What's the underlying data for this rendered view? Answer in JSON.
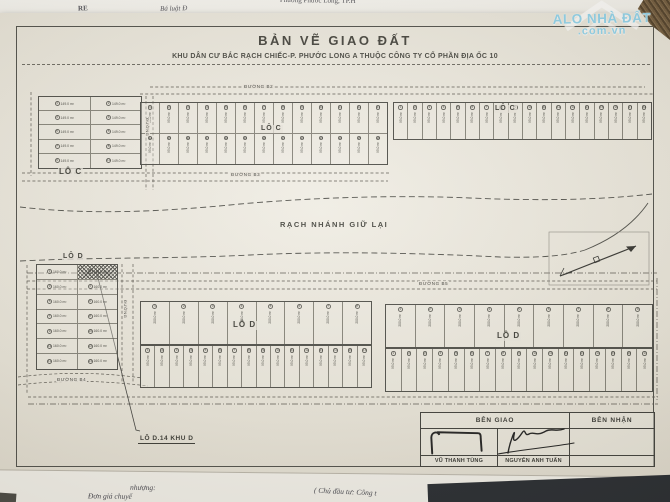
{
  "photo": {
    "watermark": {
      "line1": "ALO NHÀ ĐẤT",
      "line2": ".com.vn",
      "color": "#8ed2ea"
    },
    "underlying_papers": {
      "top_left": "RE",
      "top_mid": "Bá luật Đ",
      "top_right_1": "Phường Phước Long, TP.H",
      "top_right_2": "Phường Phước Long A",
      "bottom_mid": "nhượng:",
      "bottom_left": "Đơn giá chuyể",
      "bottom_right": "( Chủ đầu tư: Công t"
    }
  },
  "drawing": {
    "title": "BẢN VẼ GIAO ĐẤT",
    "subtitle": "KHU DÂN CƯ BẮC RẠCH CHIẾC-P. PHƯỚC LONG A THUỘC CÔNG TY CỔ PHẦN ĐỊA ỐC 10",
    "canal_label": "RẠCH NHÁNH GIỮ LẠI",
    "callout_label": "LÔ D.14 KHU D",
    "labels": {
      "lo_c": "LÔ C",
      "lo_d": "LÔ D"
    },
    "streets": {
      "top": "ĐƯỜNG B2",
      "below_upper_mid": "ĐƯỜNG B3",
      "middle": "ĐƯỜNG B5",
      "bottom_left": "ĐƯỜNG B4",
      "vertical_left": "ĐƯỜNG",
      "vertical_upper": "ĐƯỜNG"
    },
    "colors": {
      "paper": "#eae6dc",
      "ink": "#3b3b35"
    },
    "blocks": [
      {
        "name": "block-lo-c-west",
        "x": 38,
        "y": 96,
        "w": 104,
        "h": 73,
        "rows": 5,
        "cols": 2,
        "type": "wide",
        "cell_area": "149.0 m²"
      },
      {
        "name": "block-lo-c-mid",
        "x": 140,
        "y": 102,
        "w": 248,
        "h": 63,
        "rows": 2,
        "cols": 13,
        "type": "strip",
        "cell_area": "95.0 m²"
      },
      {
        "name": "block-lo-c-east",
        "x": 393,
        "y": 102,
        "w": 259,
        "h": 38,
        "rows": 1,
        "cols": 18,
        "type": "strip",
        "cell_area": "95.0 m²"
      },
      {
        "name": "block-lo-d-west",
        "x": 36,
        "y": 264,
        "w": 82,
        "h": 106,
        "rows": 7,
        "cols": 2,
        "type": "wide",
        "cell_area": "160.0 m²",
        "hatch": [
          0,
          1
        ]
      },
      {
        "name": "block-lo-d-mid-top",
        "x": 140,
        "y": 301,
        "w": 232,
        "h": 44,
        "rows": 1,
        "cols": 8,
        "type": "stripwide",
        "cell_area": "200.0 m²"
      },
      {
        "name": "block-lo-d-mid-bot",
        "x": 140,
        "y": 345,
        "w": 232,
        "h": 43,
        "rows": 1,
        "cols": 16,
        "type": "strip",
        "cell_area": "95.0 m²"
      },
      {
        "name": "block-lo-d-east-top",
        "x": 385,
        "y": 304,
        "w": 268,
        "h": 44,
        "rows": 1,
        "cols": 9,
        "type": "stripwide",
        "cell_area": "200.0 m²"
      },
      {
        "name": "block-lo-d-east-bot",
        "x": 385,
        "y": 348,
        "w": 268,
        "h": 44,
        "rows": 1,
        "cols": 17,
        "type": "strip",
        "cell_area": "95.0 m²"
      }
    ],
    "sign_table": {
      "header_giao": "BÊN GIAO",
      "header_nhan": "BÊN NHẬN",
      "signer_1": "VŨ THANH TÙNG",
      "signer_2": "NGUYỄN ANH TUẤN"
    }
  }
}
